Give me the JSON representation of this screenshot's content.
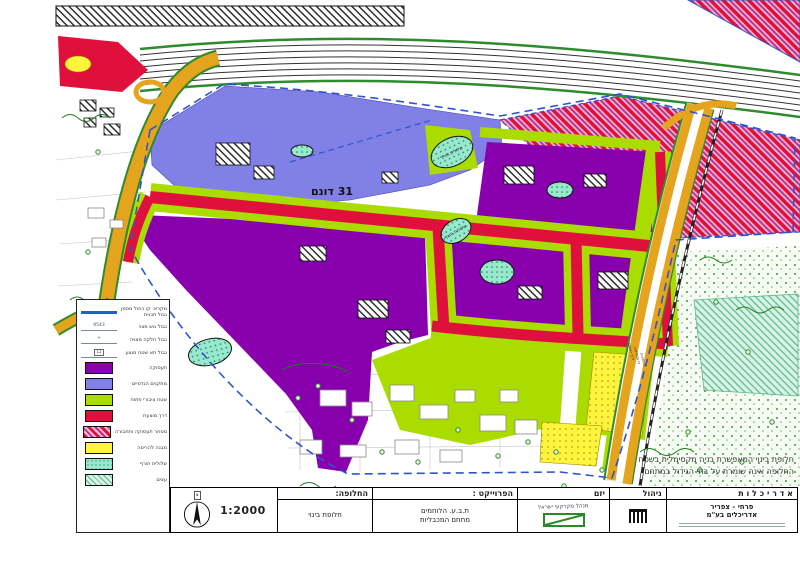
{
  "legend": {
    "boundary_items": [
      {
        "label": "מקרא: קו כחול מסמן",
        "label2": "גבול תכנית"
      },
      {
        "label": "גבול גוש מצוי",
        "tag": "9543"
      },
      {
        "label": "גבול חלקה מצויה",
        "tag": "+"
      },
      {
        "label": "גבול תא שטח מוצע",
        "tag": "11"
      }
    ],
    "zone_items": [
      {
        "label": "תעסוקה"
      },
      {
        "label": "מתקנים הנדסיים"
      },
      {
        "label": "שטח ציבורי פתוח"
      },
      {
        "label": "דרך מוצעת"
      },
      {
        "label": "מסחר תעסוקה ותחבורה"
      },
      {
        "label": "מבנה להריסה"
      },
      {
        "label": "שלולית חורף"
      },
      {
        "label": "עצים"
      }
    ]
  },
  "map": {
    "dunam_label": "31 דונם",
    "pond_label": "שלולית חורף",
    "road_label": [
      "דרך ראשית",
      "דו-מסלולית",
      "דו-נתיבית"
    ]
  },
  "titleblock": {
    "scale": "1:2000",
    "north": "צ",
    "alternative": {
      "header": "החלופה:",
      "value": "חלופת בינוי"
    },
    "project": {
      "header": "הפרוייקט :",
      "line1": "ת.ב.ע. הלוחמים",
      "line2": "מתחם המכבליות"
    },
    "developer": {
      "header": "יזם",
      "value": "מנהל מקרקעי ישראל"
    },
    "management": {
      "header": "ניהול"
    },
    "architecture": {
      "header": "א ד ר י כ ל ו ת",
      "firm1": "פרחי - צפריר",
      "firm2": "אדריכלים בע\"מ"
    },
    "note1": "חלופת בינוי המאפשרת בניה מקסימלית בשטח",
    "note2": "החלופה אינה שומרת על בתי הגידול במתחם"
  },
  "colors": {
    "employment_purple": "#8800ae",
    "facilities_periwinkle": "#8080e6",
    "open_space_chartreuse": "#aadc00",
    "proposed_road_red": "#e0103c",
    "existing_road_orange": "#e4a41e",
    "plan_boundary_blue": "#2f55cc"
  }
}
